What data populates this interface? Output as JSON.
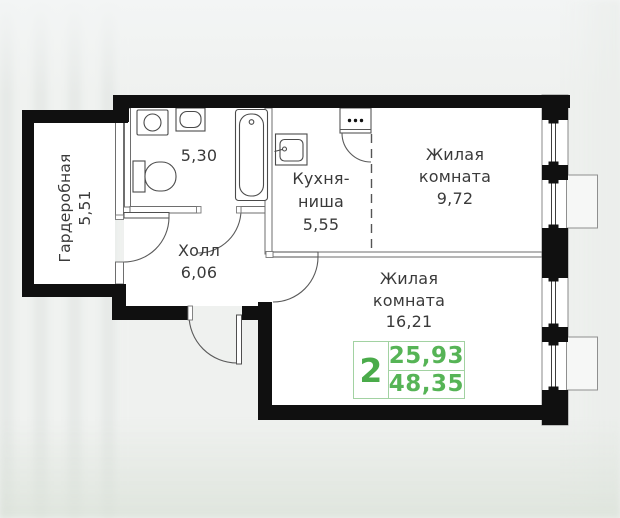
{
  "plan": {
    "rooms": {
      "wardrobe": {
        "name": "Гардеробная",
        "area": "5,51"
      },
      "bathroom": {
        "area": "5,30"
      },
      "hall": {
        "name": "Холл",
        "area": "6,06"
      },
      "kitchen": {
        "name_line1": "Кухня-",
        "name_line2": "ниша",
        "area": "5,55"
      },
      "living1": {
        "name_line1": "Жилая",
        "name_line2": "комната",
        "area": "9,72"
      },
      "living2": {
        "name_line1": "Жилая",
        "name_line2": "комната",
        "area": "16,21"
      }
    },
    "badge": {
      "rooms_count": "2",
      "living_area": "25,93",
      "total_area": "48,35"
    },
    "colors": {
      "accent_green": "#4aab4a",
      "badge_border_green": "#a2d2a2",
      "wall_black": "#101010"
    }
  }
}
